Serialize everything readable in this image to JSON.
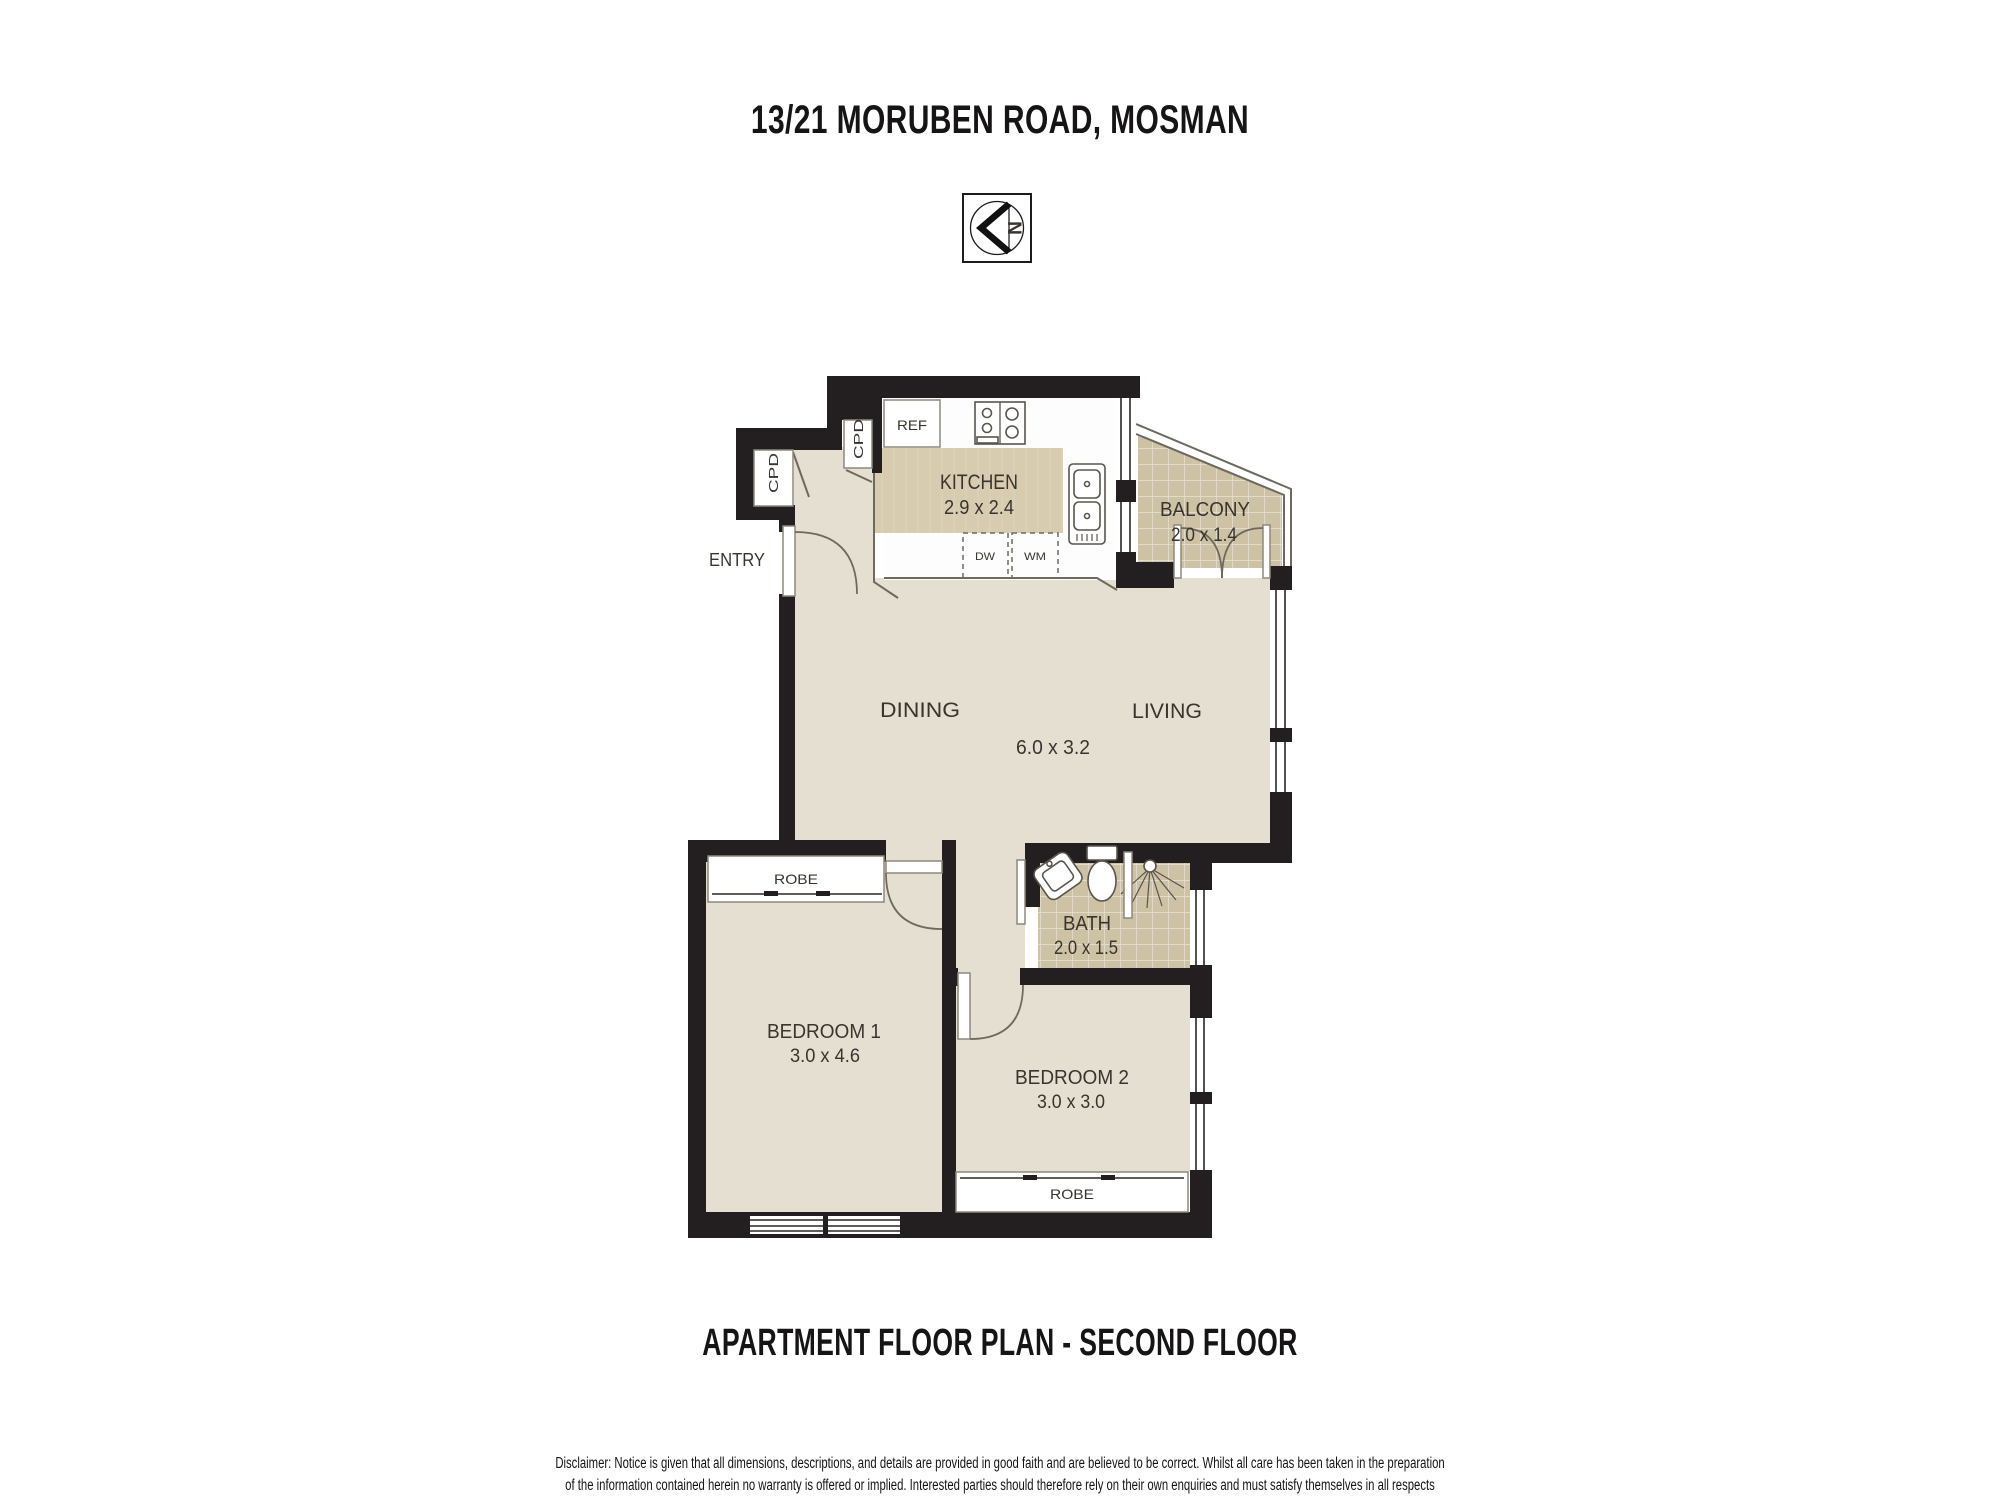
{
  "title": "13/21 MORUBEN ROAD, MOSMAN",
  "plan_caption": "APARTMENT FLOOR PLAN - SECOND FLOOR",
  "compass": {
    "north_letter": "N"
  },
  "rooms": {
    "kitchen": {
      "label": "KITCHEN",
      "dims": "2.9 x 2.4"
    },
    "balcony": {
      "label": "BALCONY",
      "dims": "2.0 x 1.4"
    },
    "entry": {
      "label": "ENTRY"
    },
    "dining": {
      "label": "DINING"
    },
    "living": {
      "label": "LIVING"
    },
    "living_dining": {
      "dims": "6.0 x 3.2"
    },
    "bath": {
      "label": "BATH",
      "dims": "2.0 x 1.5"
    },
    "bedroom1": {
      "label": "BEDROOM 1",
      "dims": "3.0 x 4.6"
    },
    "bedroom2": {
      "label": "BEDROOM 2",
      "dims": "3.0 x 3.0"
    }
  },
  "fixtures": {
    "ref": "REF",
    "cpd_entry": "CPD",
    "cpd_kitchen": "CPD",
    "dishwasher": "DW",
    "washing_machine": "WM",
    "robe_bedroom1": "ROBE",
    "robe_bedroom2": "ROBE"
  },
  "disclaimer": {
    "line1": "Disclaimer: Notice is given that all dimensions, descriptions, and details are provided in good faith and are believed to be correct. Whilst all care has been taken in the preparation",
    "line2": "of the information contained herein no warranty is offered or implied. Interested parties should therefore rely on their own enquiries and must satisfy themselves in all respects"
  },
  "colors": {
    "wall": "#231f20",
    "floor": "#e4dfd0",
    "tile": "#cdc2a3",
    "bench": "#d7ccaf",
    "detail_line": "#6e685f"
  }
}
